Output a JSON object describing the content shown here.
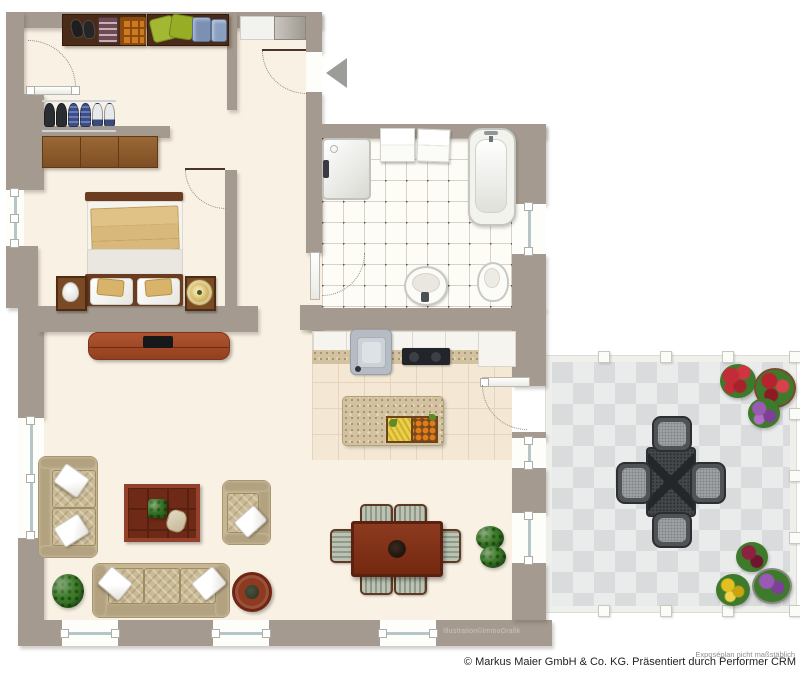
{
  "title": "Apartment floor plan illustration",
  "footer": {
    "watermark": "Illustration©immoGrafik",
    "disclaimer": "Exposéplan nicht maßstäblich",
    "copyright": "© Markus Maier GmbH & Co. KG. Präsentiert durch Performer CRM"
  },
  "colors": {
    "wall": "#a49a8f",
    "floor_cream": "#f9f1e4",
    "bathroom_tile": "#fdfcf7",
    "bathroom_dot": "#6f5340",
    "kitchen_tile": "#f4e8d5",
    "granite": "#d2c2a0",
    "terrace_tile_light": "#eaebeb",
    "terrace_tile_dark": "#d9dbdc",
    "wood_dark": "#4a2b18",
    "sideboard_wood": "#8a5a2e",
    "furniture_red_brown": "#8c3a1f",
    "sofa_beige": "#c7b694",
    "outdoor_metal": "#45484b",
    "accent_gold": "#d8b36a"
  },
  "plan": {
    "rooms": [
      "entry-hall",
      "bedroom",
      "bathroom",
      "kitchen",
      "living-dining-room",
      "terrace"
    ],
    "furniture": [
      "wardrobe-shelf",
      "shoe-rack",
      "sideboard",
      "entry-cabinet",
      "double-bed",
      "nightstands",
      "tv-lowboard",
      "shower",
      "bathtub",
      "sink",
      "toilet",
      "kitchen-counter",
      "kitchen-island",
      "dining-table-six-chairs",
      "loveseat",
      "armchair",
      "three-seat-sofa",
      "coffee-table",
      "side-table",
      "plants",
      "terrace-table-four-chairs",
      "flower-pots"
    ]
  }
}
